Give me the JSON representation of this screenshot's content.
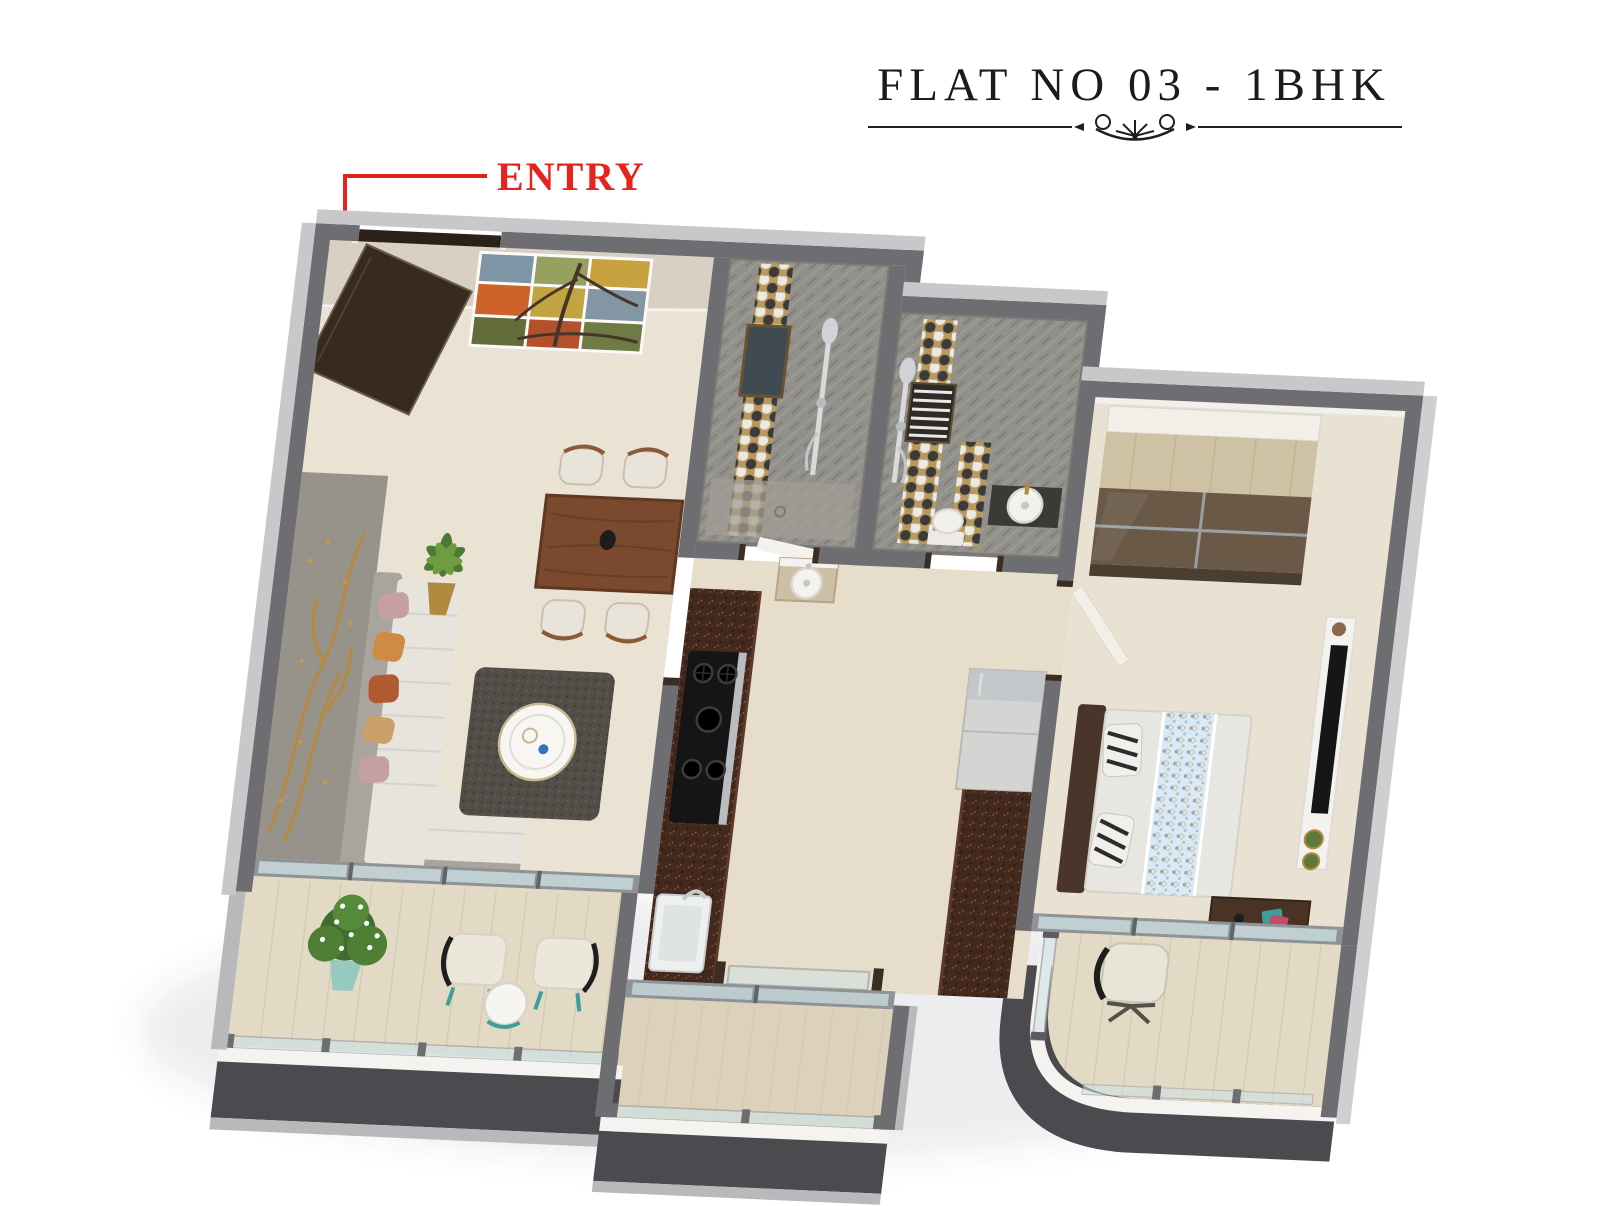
{
  "header": {
    "title": "FLAT NO 03 - 1BHK"
  },
  "annotations": {
    "entry_label": "ENTRY"
  },
  "icons": {
    "divider_ornament": "scroll-flourish",
    "entry_arrow": "down-arrow"
  },
  "colors": {
    "background": "#ffffff",
    "title_text": "#1b1b1b",
    "entry_red": "#e8221c",
    "wall_cap_gray": "#6e6e72",
    "wall_outer_light": "#c8c8cb",
    "living_floor": "#eae2d3",
    "balcony_floor": "#e3dac5",
    "bathroom_gray": "#92908a",
    "hex_tile_grout": "#b99a5e",
    "hex_tile_dark": "#3b3b39",
    "hex_tile_light": "#ece9e2",
    "kitchen_granite": "#43291d",
    "wood_table": "#7b4a2e",
    "wardrobe_tan": "#cfc1a4",
    "wardrobe_glass": "#6a5947",
    "bed_blue_accent": "#a9cbe2",
    "sofa_cushion": "#e7e4dd",
    "pillow_orange": "#cf8a43",
    "gold_art": "#b8893a",
    "balcony_fascia": "#4b4b4f",
    "teal_accent": "#3f9d9b",
    "glass_tint": "#cfe3e6"
  }
}
